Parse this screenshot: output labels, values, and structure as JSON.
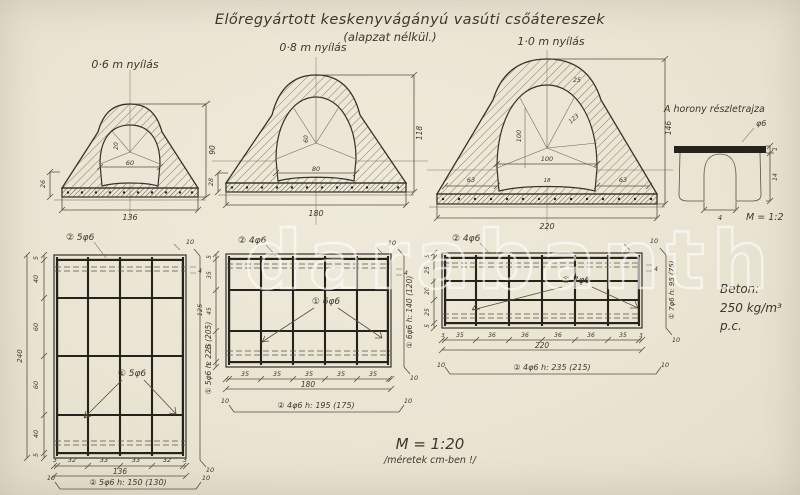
{
  "colors": {
    "paper": "#ece6d6",
    "ink": "#3d382b",
    "heavy": "#26231c",
    "watermark": "#ffffff"
  },
  "title": {
    "main": "Előregyártott keskenyvágányú  vasúti csőátereszek",
    "sub": "(alapzat nélkül.)"
  },
  "watermark": {
    "text": "darabanth"
  },
  "scale_note": {
    "line1": "M = 1:20",
    "line2": "/méretek cm-ben !/"
  },
  "material_note": {
    "line1": "Beton:",
    "line2": "250 kg/m³ p.c."
  },
  "sections": {
    "s06": {
      "label": "0·6 m nyílás",
      "height": "90",
      "width": "136",
      "side": "26",
      "inner_top": "20",
      "inner_mid": "60"
    },
    "s08": {
      "label": "0·8 m nyílás",
      "height": "118",
      "width": "180",
      "side": "28",
      "inner_w": "80",
      "inner_mid": "60"
    },
    "s10": {
      "label": "1·0 m nyílás",
      "height": "146",
      "width": "220",
      "side_l": "63",
      "side_r": "63",
      "inner_w": "100",
      "inner_h": "100",
      "radius": "123",
      "top": "25",
      "small": "18"
    }
  },
  "detail": {
    "title": "A horony részletrajza",
    "phi": "φ6",
    "dim_bottom": "4",
    "dim_r1": "1",
    "dim_r2": "14",
    "scale": "M = 1:2"
  },
  "plans": {
    "p1": {
      "top_label": "② 5φ6",
      "mid_label": "① 5φ6",
      "right_label": "① 5φ6  h: 225 (205)",
      "bottom_label": "② 5φ6  h: 150 (130)",
      "left_dims": [
        "5",
        "40",
        "60",
        "60",
        "40",
        "5"
      ],
      "left_total": "240",
      "bottom_dims": [
        "3",
        "32",
        "33",
        "33",
        "32",
        "3"
      ],
      "bottom_total": "136",
      "hook": "10",
      "top_dim": "10",
      "edge_dim": "4"
    },
    "p2": {
      "top_label": "② 4φ6",
      "mid_label": "① 6φ6",
      "right_label": "① 6φ6  h: 140 (120)",
      "bottom_label": "② 4φ6  h: 195 (175)",
      "left_dims": [
        "5",
        "35",
        "45",
        "35",
        "5"
      ],
      "left_total": "125",
      "bottom_dims": [
        "35",
        "35",
        "35",
        "35",
        "35"
      ],
      "bottom_total": "180",
      "hook": "10",
      "top_dim": "10",
      "edge_dim": "4"
    },
    "p3": {
      "top_label": "② 4φ6",
      "mid_label": "① 7φ6",
      "right_label": "① 7φ6  h: 95 (75)",
      "bottom_label": "② 4φ6  h: 235 (215)",
      "left_dims": [
        "5",
        "25",
        "20",
        "25",
        "5"
      ],
      "bottom_dims": [
        "3",
        "35",
        "36",
        "36",
        "36",
        "36",
        "35",
        "3"
      ],
      "bottom_total": "220",
      "hook": "10",
      "top_dim": "10",
      "edge_dim": "4"
    }
  }
}
